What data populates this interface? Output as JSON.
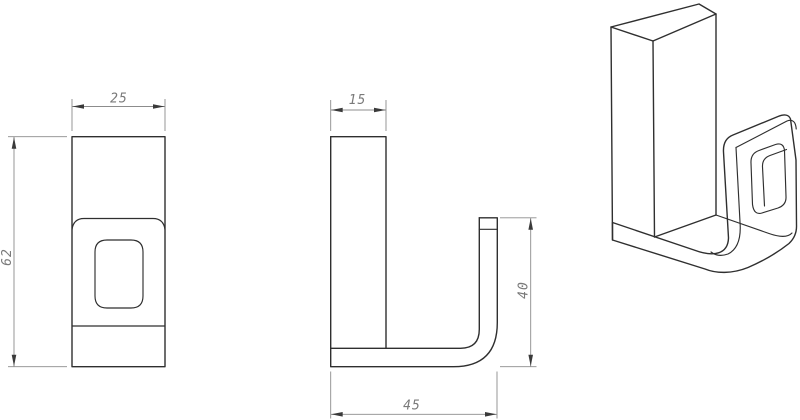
{
  "colors": {
    "background": "#ffffff",
    "object_line": "#2f2f2f",
    "dimension_line": "#8c8c8c",
    "arrow": "#3a3a3a",
    "dimension_text": "#7a7a7a"
  },
  "dims": {
    "front_width": "25",
    "front_height": "62",
    "side_depth": "15",
    "hook_height": "40",
    "base_length": "45"
  }
}
